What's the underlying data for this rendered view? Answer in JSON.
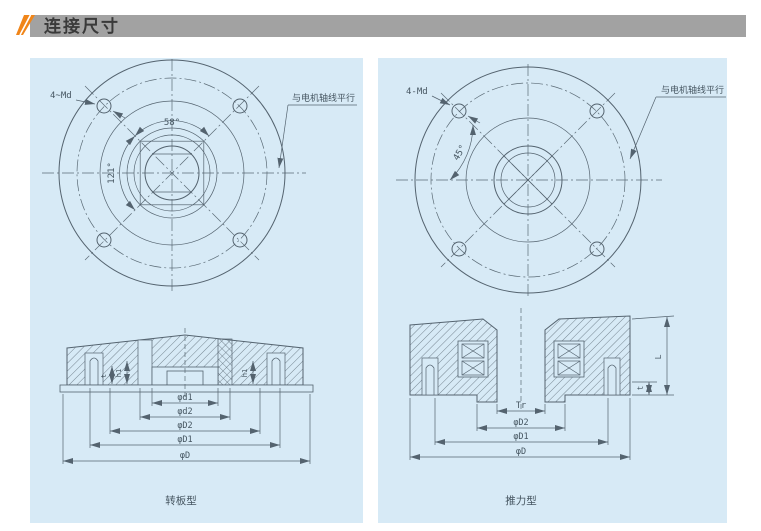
{
  "header": {
    "title": "连接尺寸"
  },
  "panels": {
    "left": {
      "caption": "转板型",
      "bolt_label": "4~Md",
      "angle_top": "58°",
      "angle_side": "121°",
      "annotation": "与电机轴线平行",
      "dim_labels": [
        "φd1",
        "φd2",
        "φD2",
        "φD1",
        "φD"
      ],
      "small_dim_labels": [
        "t",
        "h1",
        "h1"
      ]
    },
    "right": {
      "caption": "推力型",
      "bolt_label": "4-Md",
      "angle_top": "45°",
      "annotation": "与电机轴线平行",
      "dim_labels": [
        "Tr",
        "φD2",
        "φD1",
        "φD"
      ],
      "side_dim_labels": [
        "L",
        "t"
      ]
    }
  },
  "colors": {
    "accent_orange": "#f08519",
    "header_bar": "#a2a2a2",
    "header_text": "#3a3a3a",
    "panel_bg": "#d7eaf6",
    "line": "#54636f"
  }
}
